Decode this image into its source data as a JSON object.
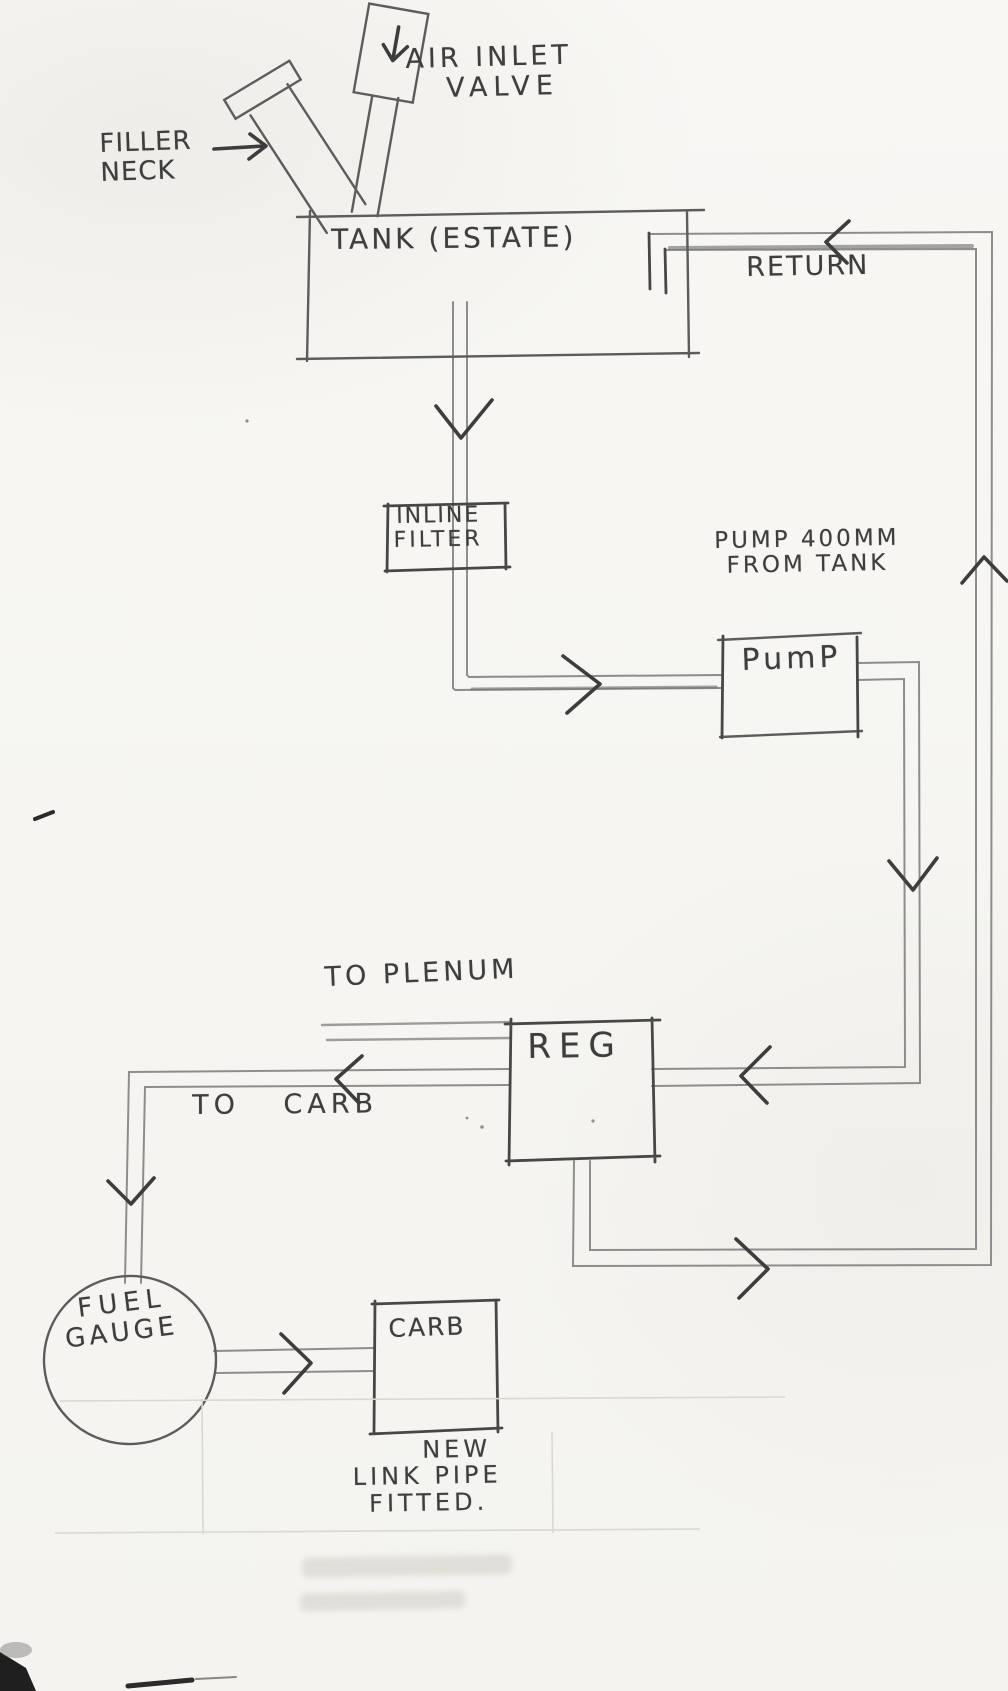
{
  "labels": {
    "air_inlet": {
      "line1": "AIR INLET",
      "line2": "VALVE"
    },
    "filler": {
      "line1": "FILLER",
      "line2": "NECK"
    },
    "tank": "TANK (ESTATE)",
    "return": "RETURN",
    "inline_filter": {
      "line1": "INLINE",
      "line2": "FILTER"
    },
    "pump_note": {
      "line1": "PUMP 400MM",
      "line2": "FROM TANK"
    },
    "pump": "PumP",
    "to_plenum": "TO PLENUM",
    "reg": "REG",
    "to_carb": "TO CARB",
    "fuel_gauge": {
      "line1": "FUEL",
      "line2": "GAUGE"
    },
    "carb": "CARB",
    "note": {
      "line1": "NEW",
      "line2": "LINK PIPE",
      "line3": "FITTED."
    }
  },
  "colors": {
    "paper": "#f7f6f2",
    "pencil_dark": "#3d3d3d",
    "pencil_mid": "#5c5c5c",
    "pencil_light": "#8d8d8d"
  }
}
